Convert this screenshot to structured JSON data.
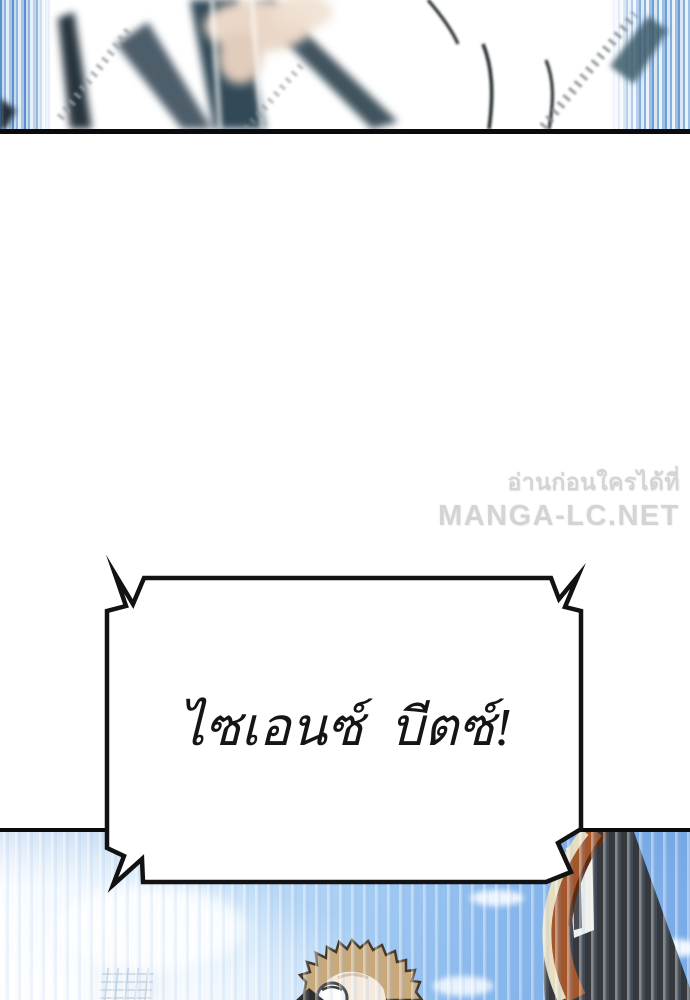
{
  "page": {
    "width": 690,
    "height": 1000,
    "background_color": "#ffffff"
  },
  "watermark": {
    "line1": "อ่านก่อนใครได้ที่",
    "line2": "MANGA-LC.NET",
    "text_color": "#d4d4d4"
  },
  "speech_bubble": {
    "text": "ไซเอนซ์ บีตซ์!",
    "fill_color": "#ffffff",
    "border_color": "#121212",
    "text_color": "#151515"
  },
  "colors": {
    "panel_border": "#0b0b0e",
    "speed_line_blue": "#5e90cc",
    "sky_blue": "#78aae6",
    "mech_orange": "#a3562a",
    "mech_cream": "#e9ddc0",
    "mech_dark": "#35393d",
    "hair_tan": "#c9a87a"
  }
}
